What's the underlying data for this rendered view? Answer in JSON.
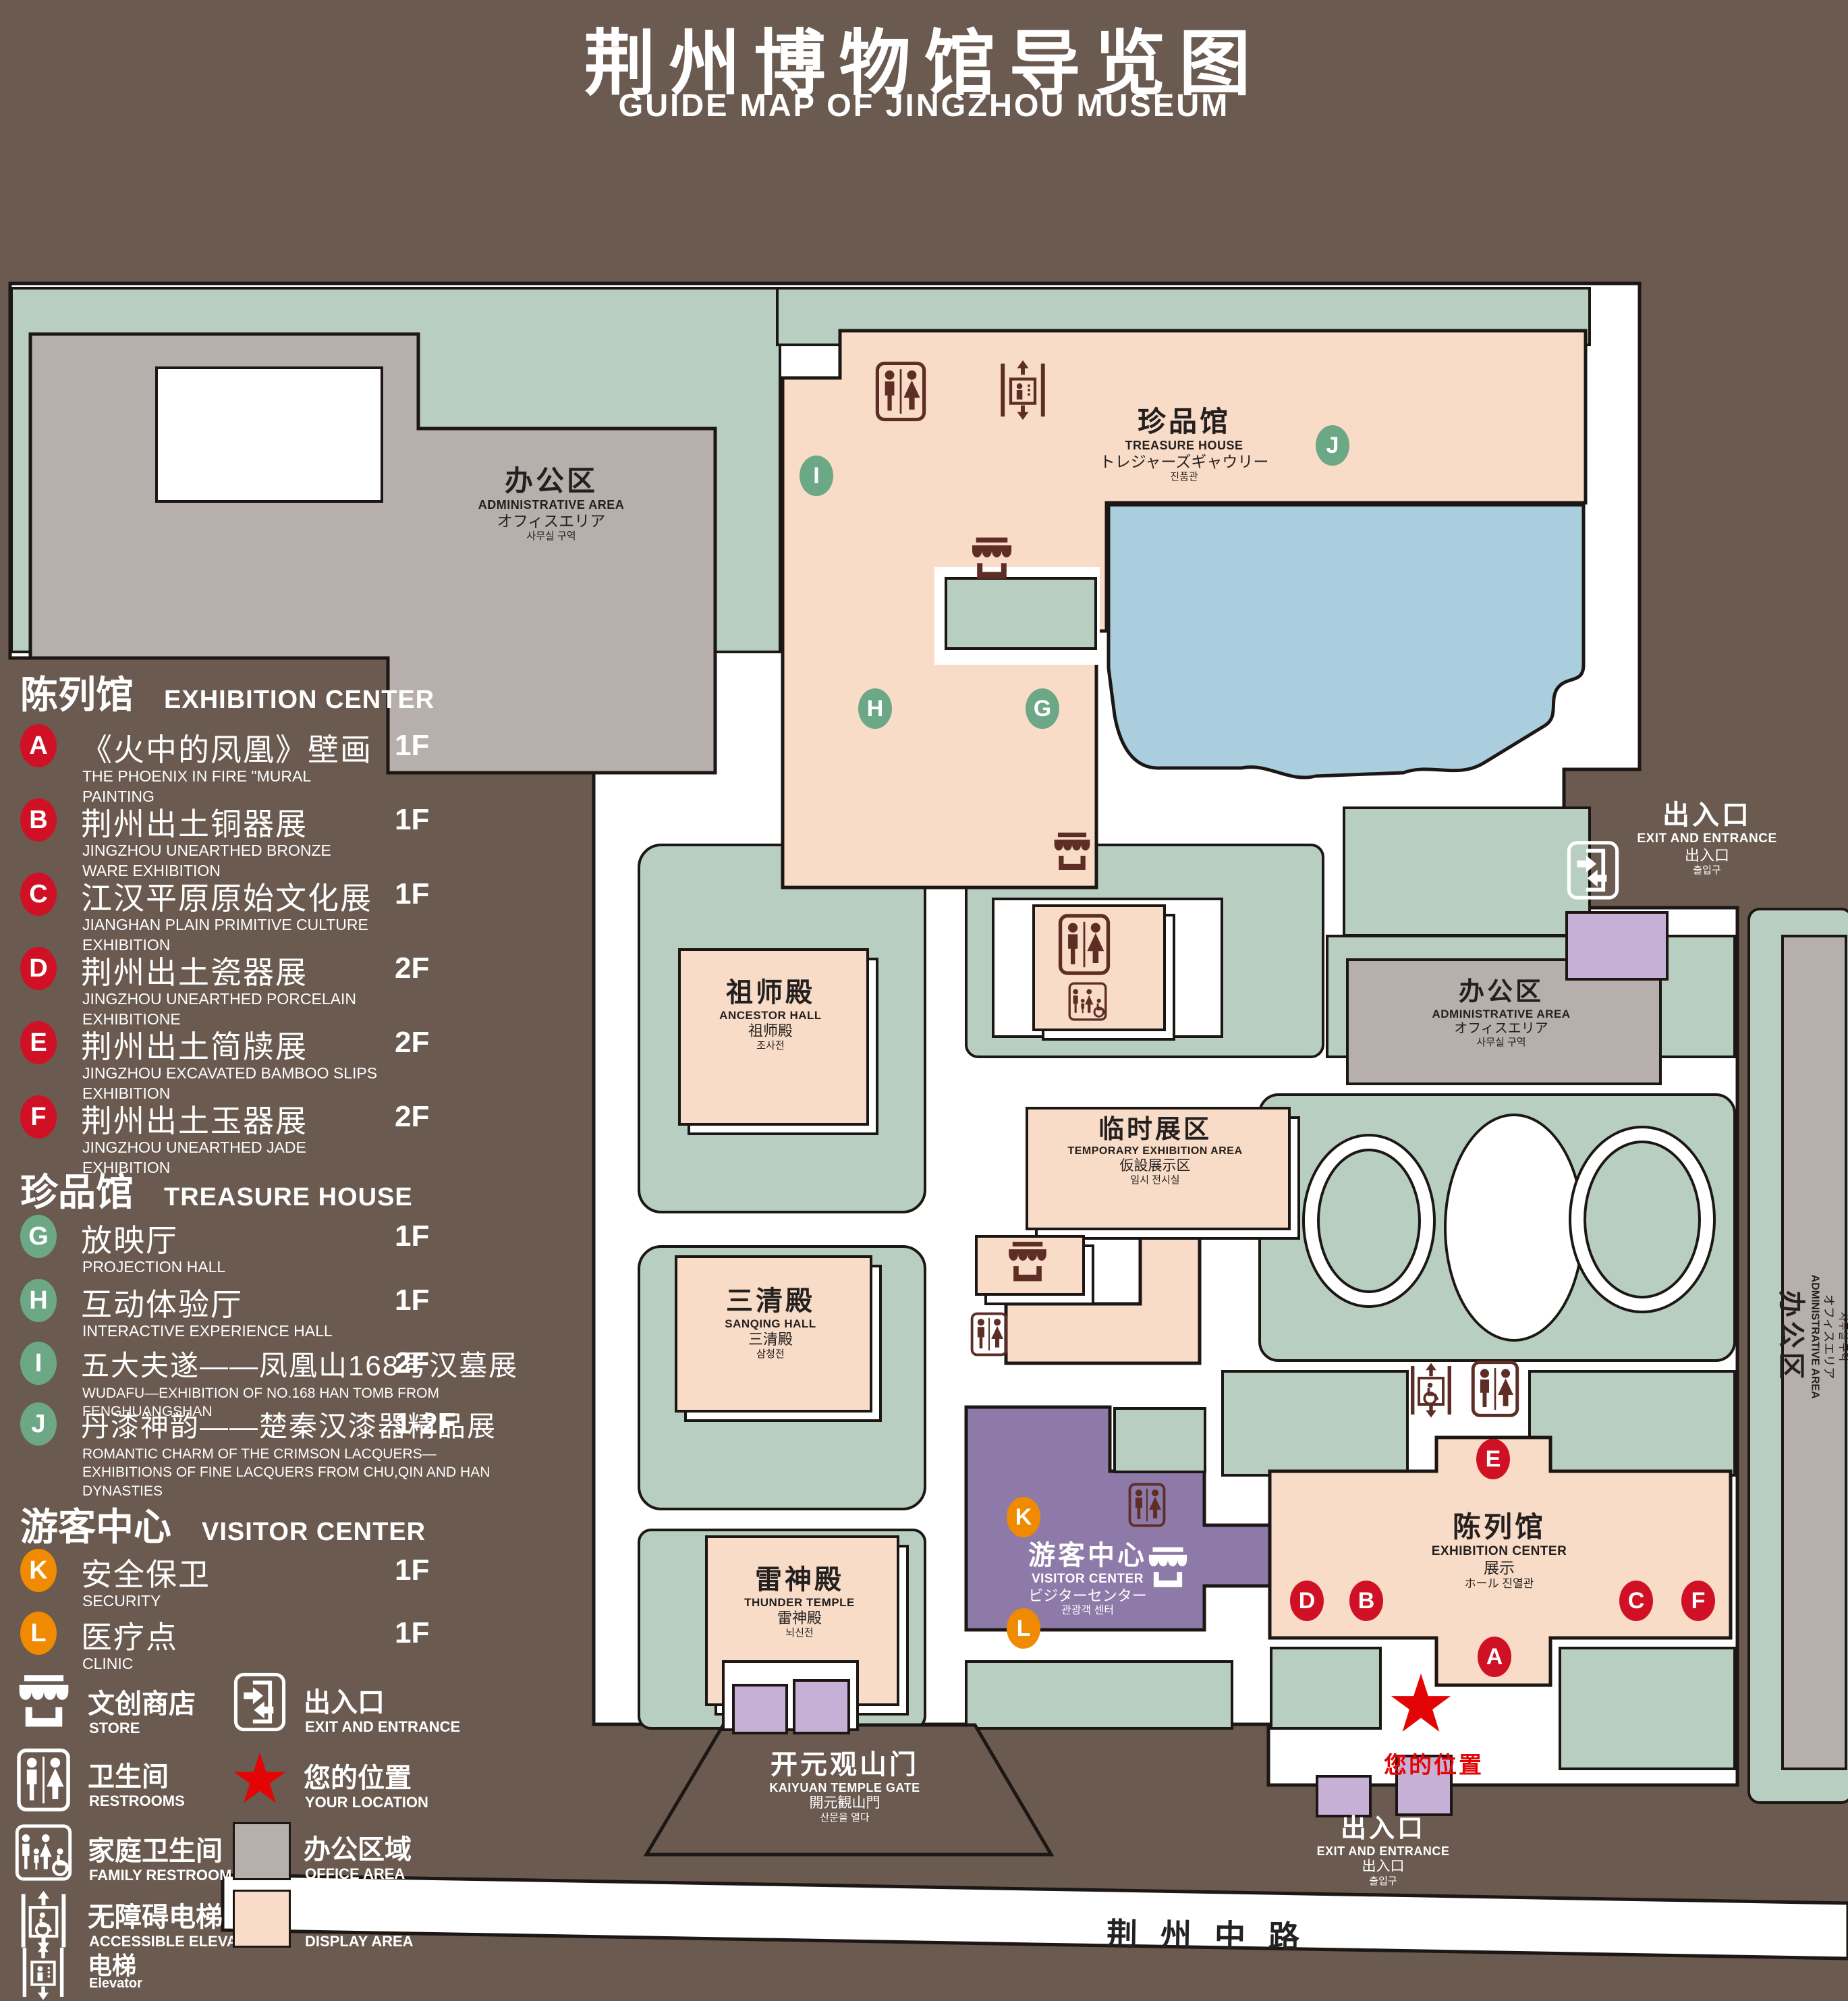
{
  "title": {
    "zh": "荆州博物馆导览图",
    "en": "GUIDE MAP OF JINGZHOU MUSEUM"
  },
  "colors": {
    "background": "#6a5a4f",
    "green_area": "#b7cec0",
    "display_area": "#f8dcc7",
    "office_area": "#b7afab",
    "pond": "#abcede",
    "visitor_center": "#8e7aa9",
    "gate_building": "#c6b0d6",
    "badge_red": "#d01125",
    "badge_green": "#6ca886",
    "badge_orange": "#f08a00",
    "icon_maroon": "#5e2d26",
    "location_red": "#e30505"
  },
  "legend": {
    "sections": [
      {
        "zh": "陈列馆",
        "en": "EXHIBITION CENTER",
        "badge_color": "#d01125",
        "items": [
          {
            "letter": "A",
            "zh": "《火中的凤凰》壁画",
            "en": "THE PHOENIX IN FIRE \"MURAL PAINTING",
            "floor": "1F"
          },
          {
            "letter": "B",
            "zh": "荆州出土铜器展",
            "en": "JINGZHOU UNEARTHED BRONZE WARE EXHIBITION",
            "floor": "1F"
          },
          {
            "letter": "C",
            "zh": "江汉平原原始文化展",
            "en": "JIANGHAN PLAIN PRIMITIVE CULTURE EXHIBITION",
            "floor": "1F"
          },
          {
            "letter": "D",
            "zh": "荆州出土瓷器展",
            "en": "JINGZHOU UNEARTHED PORCELAIN EXHIBITIONE",
            "floor": "2F"
          },
          {
            "letter": "E",
            "zh": "荆州出土简牍展",
            "en": "JINGZHOU EXCAVATED BAMBOO SLIPS EXHIBITION",
            "floor": "2F"
          },
          {
            "letter": "F",
            "zh": "荆州出土玉器展",
            "en": "JINGZHOU UNEARTHED JADE EXHIBITION",
            "floor": "2F"
          }
        ]
      },
      {
        "zh": "珍品馆",
        "en": "TREASURE HOUSE",
        "badge_color": "#6ca886",
        "items": [
          {
            "letter": "G",
            "zh": "放映厅",
            "en": "PROJECTION HALL",
            "floor": "1F"
          },
          {
            "letter": "H",
            "zh": "互动体验厅",
            "en": "INTERACTIVE EXPERIENCE HALL",
            "floor": "1F"
          },
          {
            "letter": "I",
            "zh": "五大夫遂——凤凰山168号汉墓展",
            "en": "WUDAFU—EXHIBITION OF NO.168 HAN TOMB FROM FENGHUANGSHAN",
            "floor": "2F"
          },
          {
            "letter": "J",
            "zh": "丹漆神韵——楚秦汉漆器精品展",
            "en": "ROMANTIC CHARM OF THE CRIMSON LACQUERS—EXHIBITIONS OF FINE LACQUERS FROM CHU,QIN AND HAN DYNASTIES",
            "floor": "1-2F"
          }
        ]
      },
      {
        "zh": "游客中心",
        "en": "VISITOR CENTER",
        "badge_color": "#f08a00",
        "items": [
          {
            "letter": "K",
            "zh": "安全保卫",
            "en": "SECURITY",
            "floor": "1F"
          },
          {
            "letter": "L",
            "zh": "医疗点",
            "en": "CLINIC",
            "floor": "1F"
          }
        ]
      }
    ],
    "symbols": [
      {
        "icon": "store-icon",
        "zh": "文创商店",
        "en": "STORE"
      },
      {
        "icon": "exit-icon",
        "zh": "出入口",
        "en": "EXIT AND ENTRANCE"
      },
      {
        "icon": "restrooms-icon",
        "zh": "卫生间",
        "en": "RESTROOMS"
      },
      {
        "icon": "location-star",
        "zh": "您的位置",
        "en": "YOUR LOCATION"
      },
      {
        "icon": "family-restroom-icon",
        "zh": "家庭卫生间",
        "en": "FAMILY RESTROOMS"
      },
      {
        "icon": "office-area-swatch",
        "zh": "办公区域",
        "en": "OFFICE AREA"
      },
      {
        "icon": "accessible-elevator-icon",
        "zh": "无障碍电梯",
        "en": "ACCESSIBLE ELEVATOR"
      },
      {
        "icon": "display-area-swatch",
        "zh": "展示区域",
        "en": "DISPLAY AREA"
      },
      {
        "icon": "elevator-icon",
        "zh": "电梯",
        "en": "Elevator"
      }
    ]
  },
  "map": {
    "treasure_house": {
      "zh": "珍品馆",
      "en": "TREASURE HOUSE",
      "jp": "トレジャーズギャウリー",
      "kr": "진품관"
    },
    "admin_top_left": {
      "zh": "办公区",
      "en": "ADMINISTRATIVE AREA",
      "jp": "オフィスエリア",
      "kr": "사무실 구역"
    },
    "admin_center": {
      "zh": "办公区",
      "en": "ADMINISTRATIVE AREA",
      "jp": "オフィスエリア",
      "kr": "사무실 구역"
    },
    "admin_right": {
      "zh": "办公区",
      "en": "ADMINISTRATIVE AREA",
      "jp": "オフィスエリア",
      "kr": "사무실 구역"
    },
    "ancestor_hall": {
      "zh": "祖师殿",
      "en": "ANCESTOR HALL",
      "jp": "祖师殿",
      "kr": "조사전"
    },
    "sanqing_hall": {
      "zh": "三清殿",
      "en": "SANQING HALL",
      "jp": "三清殿",
      "kr": "삼청전"
    },
    "thunder_temple": {
      "zh": "雷神殿",
      "en": "THUNDER TEMPLE",
      "jp": "雷神殿",
      "kr": "뇌신전"
    },
    "temporary_area": {
      "zh": "临时展区",
      "en": "TEMPORARY EXHIBITION AREA",
      "jp": "仮設展示区",
      "kr": "임시 전시실"
    },
    "visitor_center": {
      "zh": "游客中心",
      "en": "VISITOR CENTER",
      "jp": "ビジターセンター",
      "kr": "관광객 센터"
    },
    "exhibition_center": {
      "zh": "陈列馆",
      "en": "EXHIBITION CENTER",
      "l3": "展示",
      "l4": "ホール 진열관"
    },
    "exit_right": {
      "zh": "出入口",
      "en": "EXIT AND ENTRANCE",
      "jp": "出入口",
      "kr": "출입구"
    },
    "exit_bottom": {
      "zh": "出入口",
      "en": "EXIT AND ENTRANCE",
      "jp": "出入口",
      "kr": "출입구"
    },
    "gate": {
      "zh": "开元观山门",
      "en": "KAIYUAN TEMPLE GATE",
      "jp": "開元観山門",
      "kr": "산문을 열다"
    },
    "road": "荆州中路",
    "your_location": "您的位置"
  }
}
